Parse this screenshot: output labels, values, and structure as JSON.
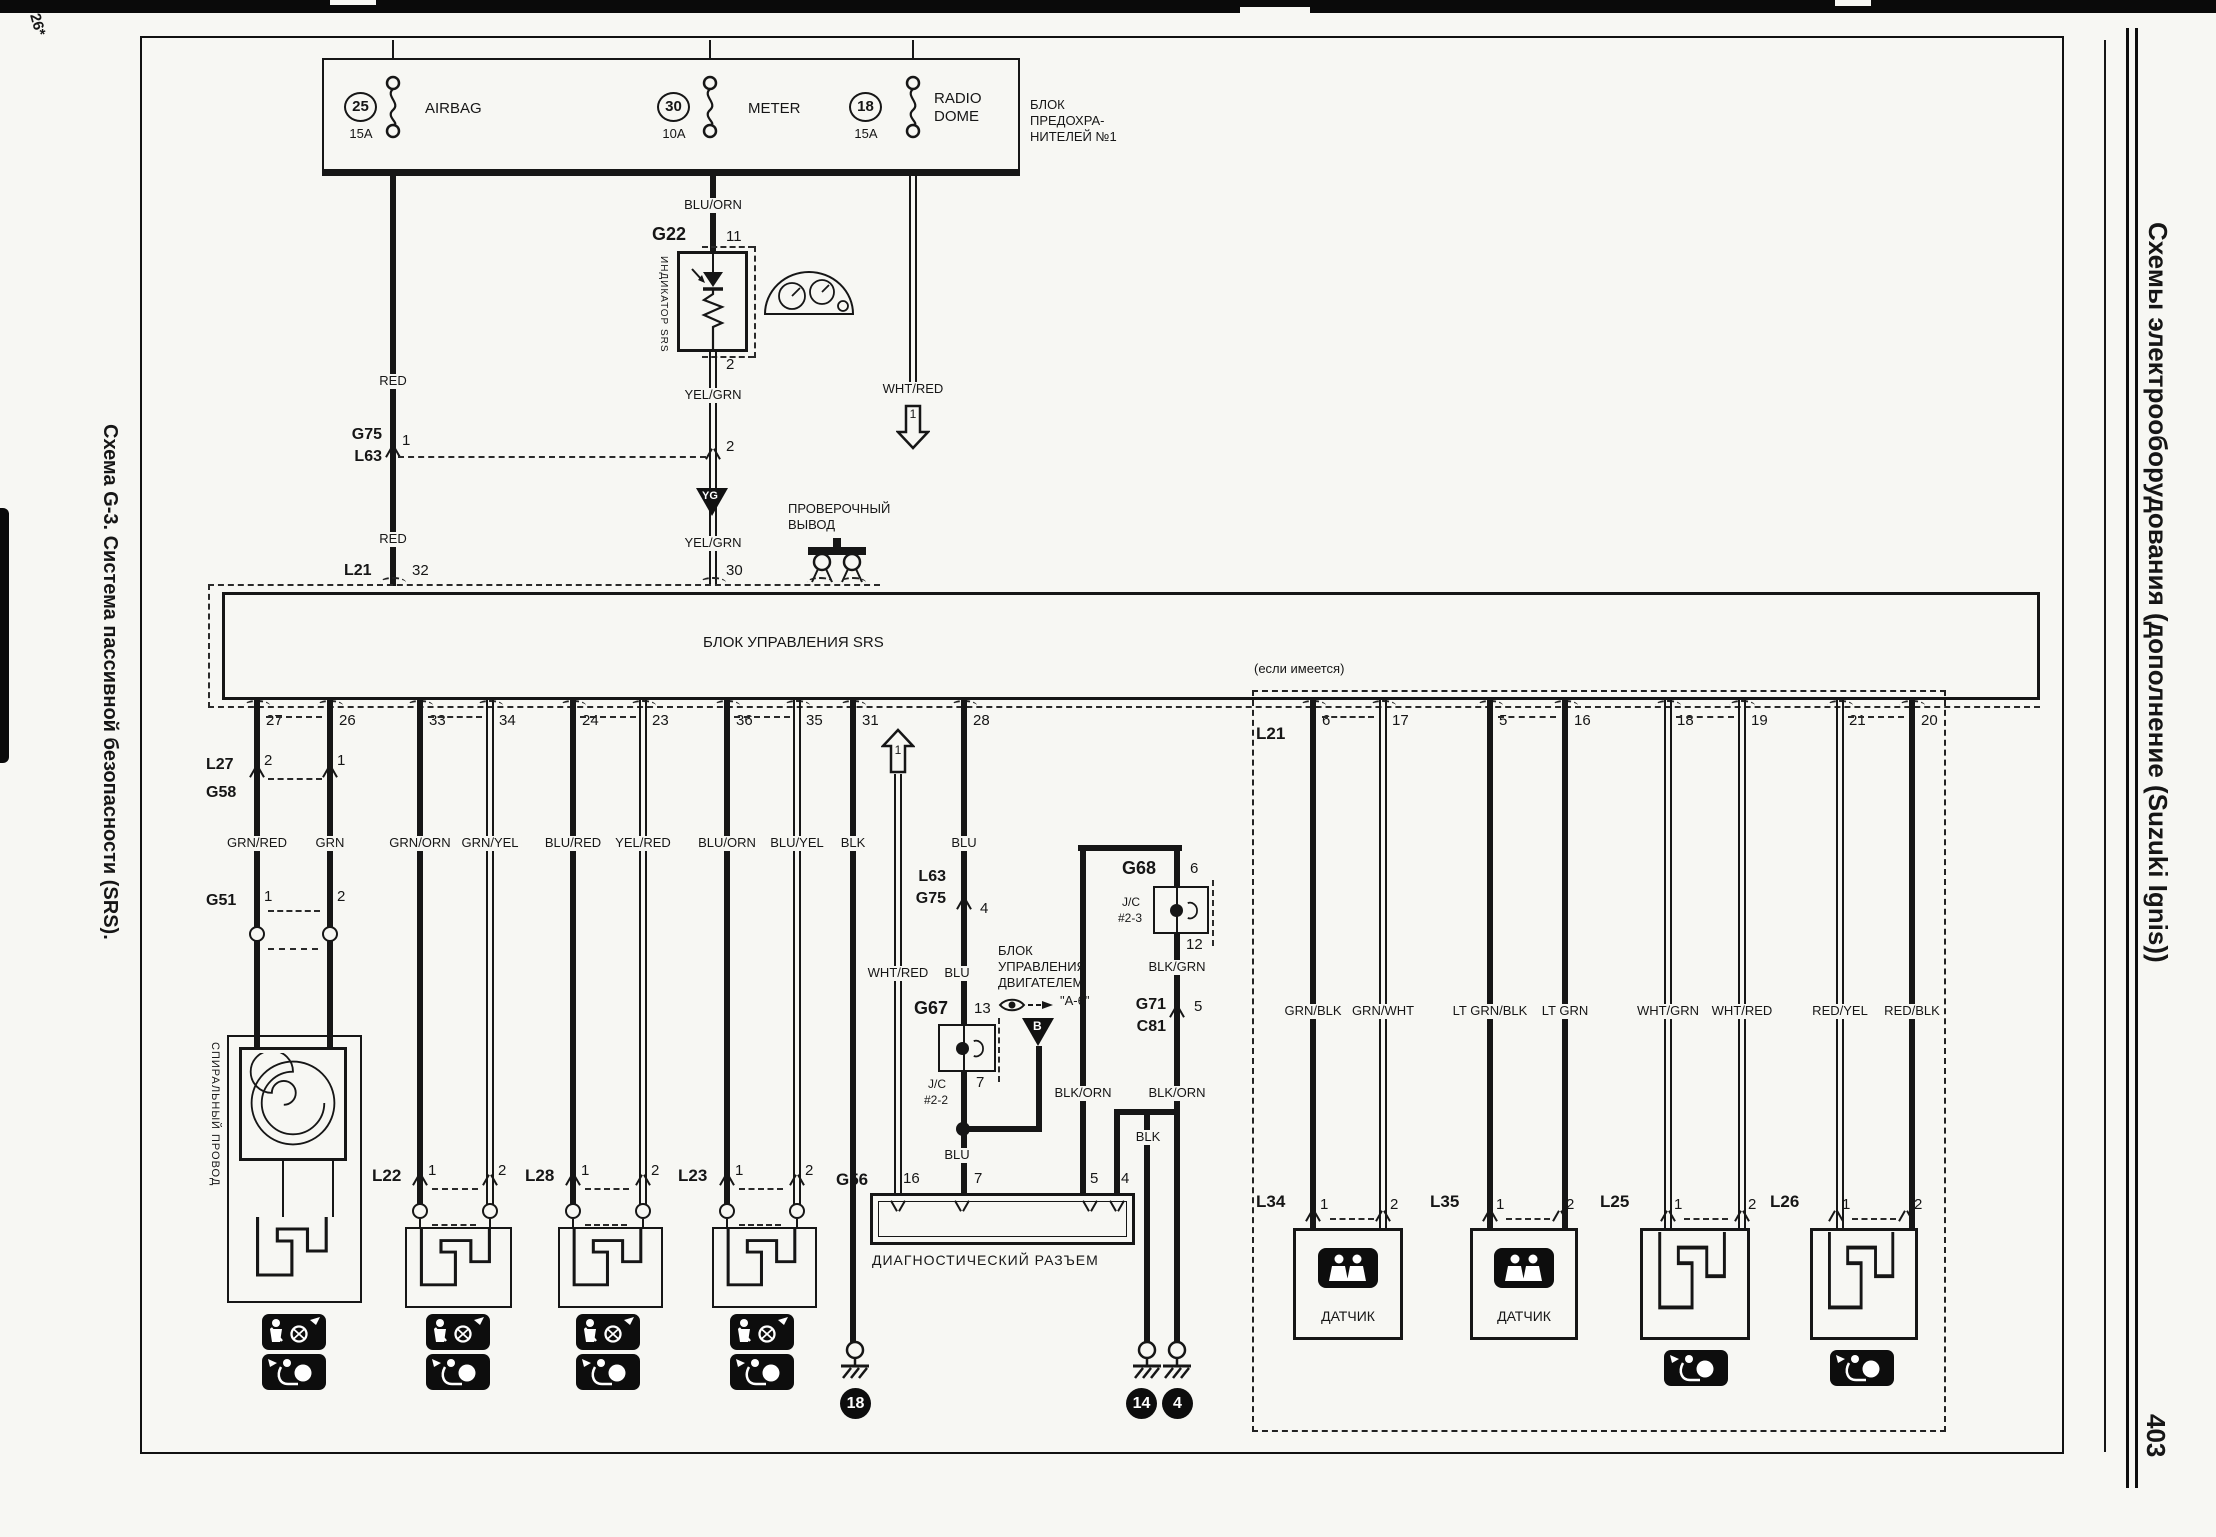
{
  "page": {
    "corner_mark": "26*",
    "left_title": "Схема G-3. Система пассивной безопасности (SRS).",
    "right_title": "Схемы электрооборудования (дополнение (Suzuki Ignis))",
    "page_number": "403"
  },
  "fusebox": {
    "title_l1": "БЛОК",
    "title_l2": "ПРЕДОХРА-",
    "title_l3": "НИТЕЛЕЙ №1",
    "fuse1_num": "25",
    "fuse1_amps": "15A",
    "fuse1_name": "AIRBAG",
    "fuse2_num": "30",
    "fuse2_amps": "10A",
    "fuse2_name": "METER",
    "fuse3_num": "18",
    "fuse3_amps": "15A",
    "fuse3_name_l1": "RADIO",
    "fuse3_name_l2": "DOME"
  },
  "top": {
    "red_upper": "RED",
    "red_lower": "RED",
    "blu_orn": "BLU/ORN",
    "g22": "G22",
    "g22_pin_in": "11",
    "g22_pin_out": "2",
    "indicator": "ИНДИКАТОР SRS",
    "yel_grn_upper": "YEL/GRN",
    "yel_grn_lower": "YEL/GRN",
    "g75": "G75",
    "l63": "L63",
    "g75_pin": "1",
    "link_pin": "2",
    "yg": "YG",
    "l21": "L21",
    "pin32": "32",
    "pin30": "30",
    "wht_red": "WHT/RED",
    "ref1": "1",
    "test_l1": "ПРОВЕРОЧНЫЙ",
    "test_l2": "ВЫВОД"
  },
  "srs": {
    "label": "БЛОК УПРАВЛЕНИЯ SRS"
  },
  "left_pins": [
    "27",
    "26",
    "33",
    "34",
    "24",
    "23",
    "36",
    "35",
    "31",
    "28"
  ],
  "left_colors": [
    "GRN/RED",
    "GRN",
    "GRN/ORN",
    "GRN/YEL",
    "BLU/RED",
    "YEL/RED",
    "BLU/ORN",
    "BLU/YEL",
    "BLK",
    "BLU"
  ],
  "mid": {
    "l27": "L27",
    "g58": "G58",
    "l27_pin1": "2",
    "l27_pin2": "1",
    "g51": "G51",
    "g51_pin1": "1",
    "g51_pin2": "2",
    "spiral": "СПИРАЛЬНЫЙ ПРОВОД",
    "l22": "L22",
    "l28": "L28",
    "l23": "L23",
    "pin1": "1",
    "pin2": "2",
    "ref1": "1",
    "wht_red": "WHT/RED",
    "blu_b": "BLU",
    "blu_c": "BLU",
    "l63": "L63",
    "g75": "G75",
    "l63_pin": "4",
    "g67": "G67",
    "g67_pin_top": "13",
    "g67_pin_bot": "7",
    "jc2_l1": "J/C",
    "jc2_l2": "#2-2",
    "ecu_l1": "БЛОК",
    "ecu_l2": "УПРАВЛЕНИЯ",
    "ecu_l3": "ДВИГАТЕЛЕМ",
    "a6": "\"A-6\"",
    "b_ref": "B",
    "g68": "G68",
    "g68_pin_top": "6",
    "g68_pin_bot": "12",
    "jc3_l1": "J/C",
    "jc3_l2": "#2-3",
    "blk_grn": "BLK/GRN",
    "g71": "G71",
    "c81": "C81",
    "g71_pin": "5",
    "blk_orn_left": "BLK/ORN",
    "blk_orn_right": "BLK/ORN",
    "blk": "BLK",
    "g56": "G56",
    "g56_pin16": "16",
    "g56_pin7": "7",
    "g56_pin5": "5",
    "g56_pin4": "4",
    "diag_label": "ДИАГНОСТИЧЕСКИЙ РАЗЪЕМ",
    "gnd18": "18",
    "gnd14": "14",
    "gnd4": "4"
  },
  "right": {
    "note": "(если имеется)",
    "l21": "L21",
    "pins": [
      "6",
      "17",
      "5",
      "16",
      "18",
      "19",
      "21",
      "20"
    ],
    "colors": [
      "GRN/BLK",
      "GRN/WHT",
      "LT GRN/BLK",
      "LT GRN",
      "WHT/GRN",
      "WHT/RED",
      "RED/YEL",
      "RED/BLK"
    ],
    "l34": "L34",
    "l35": "L35",
    "l25": "L25",
    "l26": "L26",
    "pin1": "1",
    "pin2": "2",
    "sensor1": "ДАТЧИК",
    "sensor2": "ДАТЧИК"
  }
}
